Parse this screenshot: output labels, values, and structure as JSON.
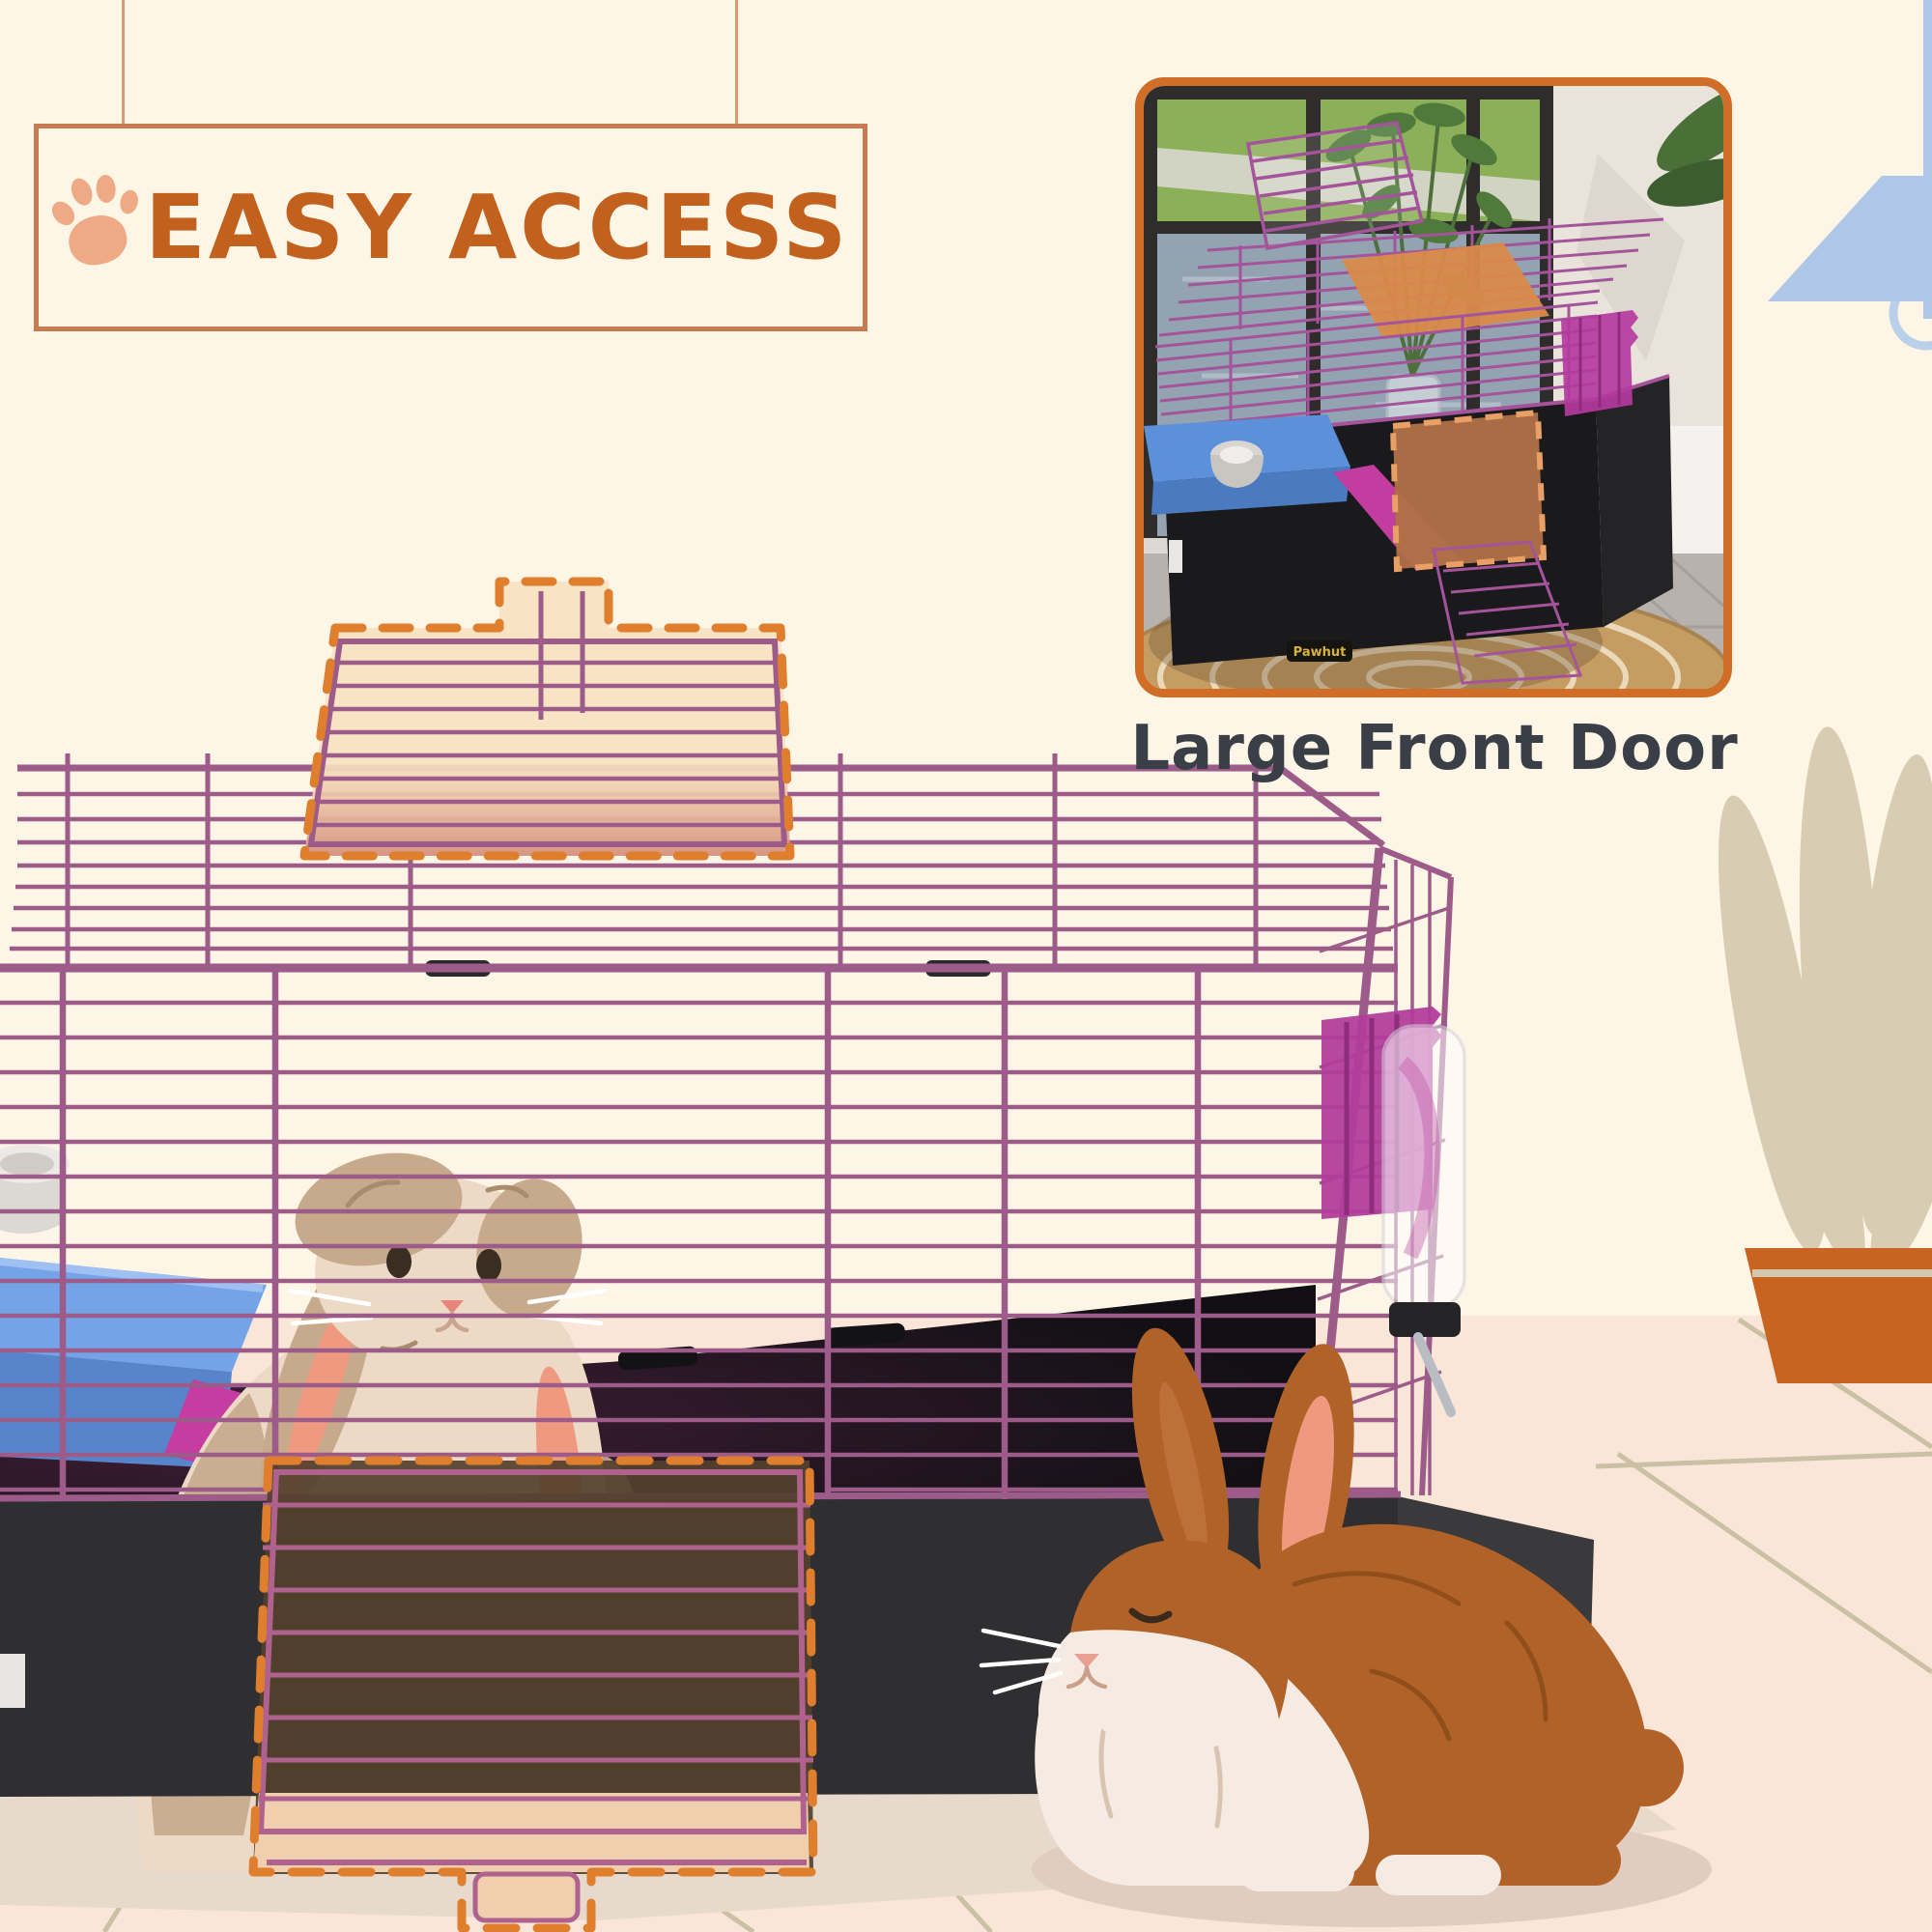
{
  "page": {
    "kind": "pet-cage product feature graphic"
  },
  "sign": {
    "title": "EASY ACCESS",
    "icon": "paw-icon"
  },
  "inset": {
    "caption": "Large Front Door",
    "brand_logo": "Pawhut"
  },
  "palette": {
    "background": "#fdf5e5",
    "floor": "#fae6d8",
    "floor_shadow": "#e7d9cb",
    "tile_line": "#c8bfa2",
    "accent_orange": "#c2611d",
    "dash_orange": "#df7e2d",
    "sign_border": "#c87a52",
    "string": "#d89c72",
    "paw": "#edaa85",
    "caption_text": "#3a3e46",
    "photo_border": "#d06e28",
    "cage_wire": "#9c5b88",
    "cage_wire_dark": "#7c4468",
    "flap_wire": "#b0628f",
    "cage_base": "#2f2e30",
    "cage_base_light": "#3a393b",
    "cage_interior": "#121014",
    "door_fill_top": "#f7e1c2",
    "door_fill_front": "#54412e",
    "door_tab": "#f0cfae",
    "platform_blue": "#75a3e8",
    "platform_blue_dark": "#5884cc",
    "ramp_pink": "#c53da0",
    "hay_rack_pink": "#b23d9b",
    "rabbit_cream": "#ecd9c6",
    "rabbit_tan": "#c7a98b",
    "rabbit_ear_pink": "#ef9a80",
    "rabbit_brown": "#b06228",
    "rabbit_white": "#f6ebe2",
    "plant_leaf": "#d8cdb2",
    "plant_pot": "#c8641f",
    "lamp_blue": "#aec6e8"
  }
}
